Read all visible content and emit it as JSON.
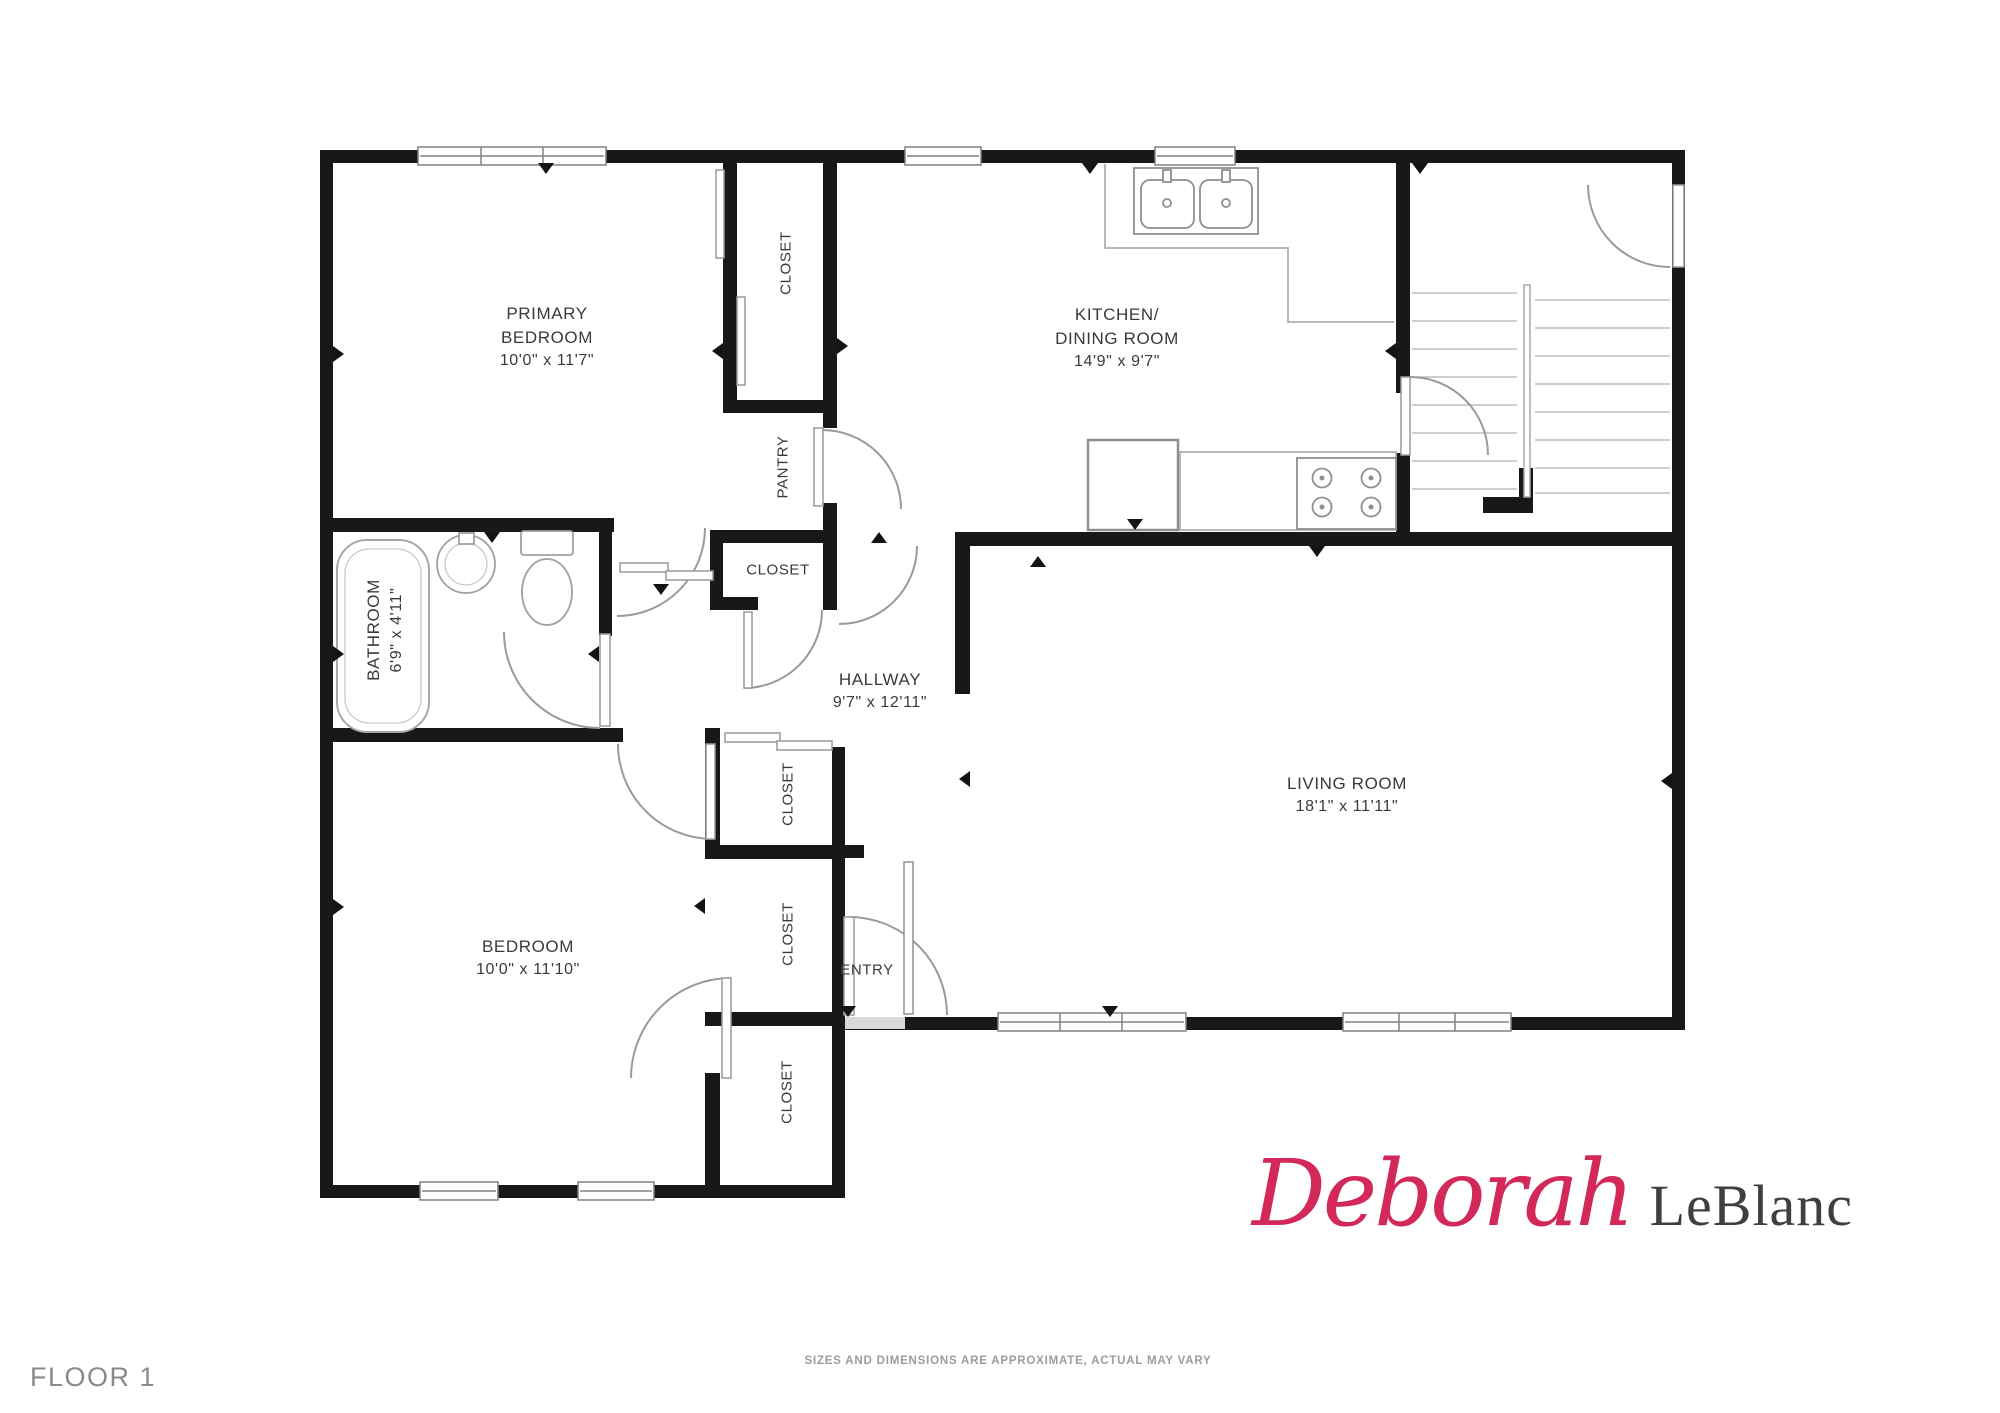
{
  "page": {
    "floor_label": "FLOOR 1",
    "disclaimer": "SIZES AND DIMENSIONS ARE APPROXIMATE, ACTUAL MAY VARY"
  },
  "branding": {
    "first_name": "Deborah",
    "last_name": "LeBlanc",
    "accent_color": "#d3285a"
  },
  "rooms": {
    "primary_bedroom": {
      "line1": "PRIMARY",
      "line2": "BEDROOM",
      "dims": "10'0\" x 11'7\""
    },
    "kitchen_dining": {
      "line1": "KITCHEN/",
      "line2": "DINING ROOM",
      "dims": "14'9\" x 9'7\""
    },
    "hallway": {
      "line1": "HALLWAY",
      "dims": "9'7\" x 12'11\""
    },
    "living_room": {
      "line1": "LIVING ROOM",
      "dims": "18'1\" x 11'11\""
    },
    "bedroom": {
      "line1": "BEDROOM",
      "dims": "10'0\" x 11'10\""
    },
    "bathroom": {
      "line1": "BATHROOM",
      "dims": "6'9\" x 4'11\""
    },
    "pantry": {
      "label": "PANTRY"
    },
    "entry": {
      "label": "ENTRY"
    },
    "closet_primary": {
      "label": "CLOSET"
    },
    "closet_hall": {
      "label": "CLOSET"
    },
    "closet_upper": {
      "label": "CLOSET"
    },
    "closet_middle": {
      "label": "CLOSET"
    },
    "closet_lower": {
      "label": "CLOSET"
    }
  }
}
